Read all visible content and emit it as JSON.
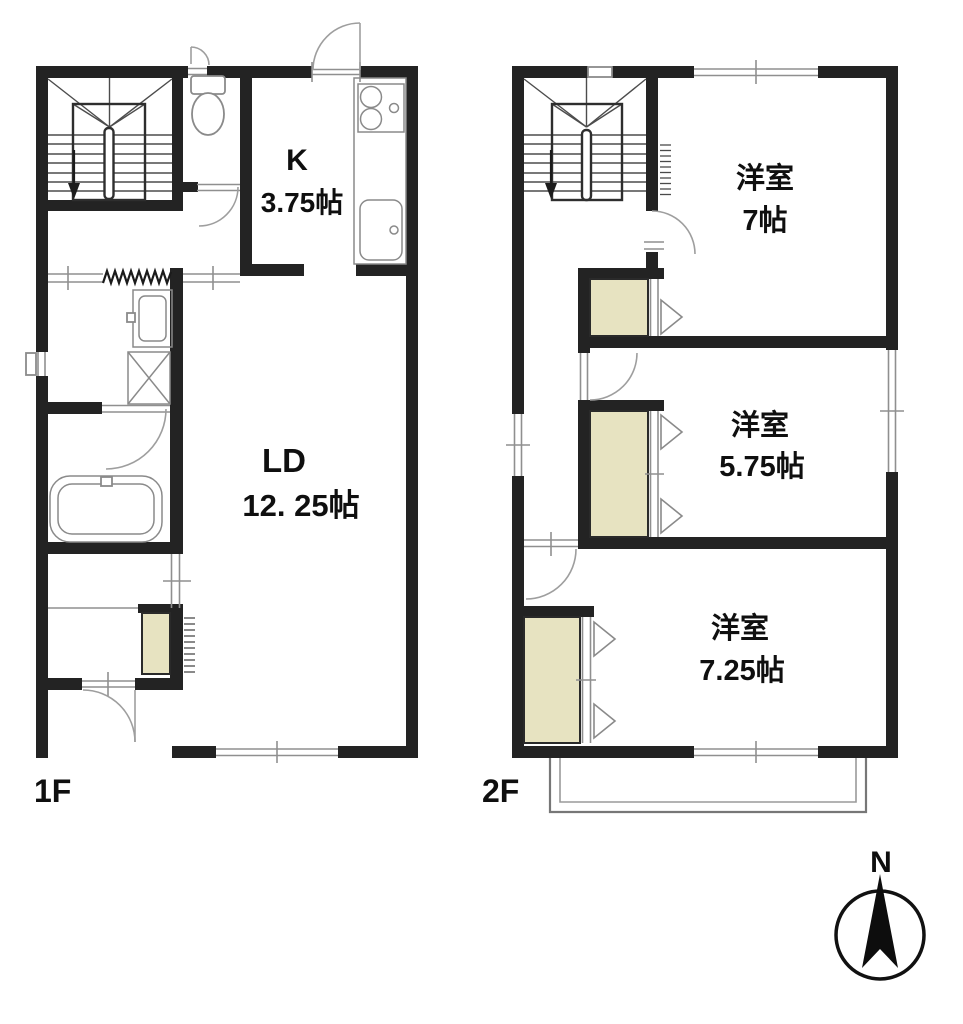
{
  "floorplan": {
    "floor1": {
      "floor_label": "1F",
      "kitchen_label": "K",
      "kitchen_size": "3.75帖",
      "living_label": "LD",
      "living_size": "12. 25帖"
    },
    "floor2": {
      "floor_label": "2F",
      "room1_label": "洋室",
      "room1_size": "7帖",
      "room2_label": "洋室",
      "room2_size": "5.75帖",
      "room3_label": "洋室",
      "room3_size": "7.25帖"
    },
    "compass": {
      "north_label": "N"
    },
    "colors": {
      "wall": "#232323",
      "closet_fill": "#e7e3c1",
      "line": "#8f8f8f",
      "background": "#ffffff"
    }
  }
}
